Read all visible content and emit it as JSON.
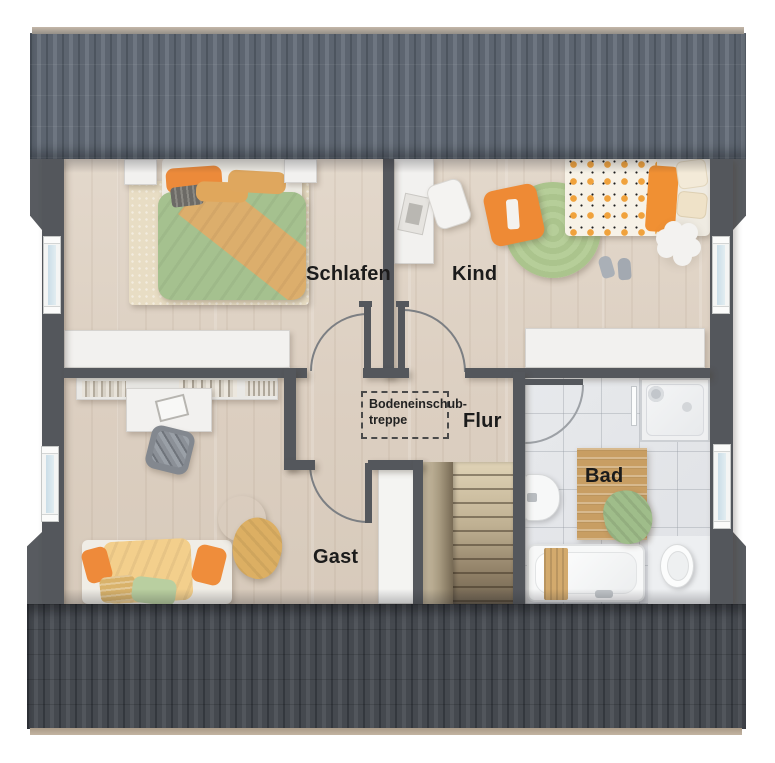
{
  "floorplan": {
    "rooms": {
      "schlafen": "Schlafen",
      "kind": "Kind",
      "flur": "Flur",
      "gast": "Gast",
      "bad": "Bad"
    },
    "annotation": {
      "attic_line1": "Bodeneinschub-",
      "attic_line2": "treppe"
    },
    "palette": {
      "roof_top": "#5e6670",
      "roof_bottom": "#45484e",
      "wall": "#54575c",
      "floor_wood": "#ddd1c3",
      "bath_tile": "#e3e5e8",
      "accent_orange": "#ec8a3a",
      "accent_green": "#a5c18f",
      "accent_tan": "#dcae6c",
      "rug_cream": "#e8ddc4",
      "rug_green": "#b2cb94",
      "window_glass": "#cfe0e8"
    }
  }
}
